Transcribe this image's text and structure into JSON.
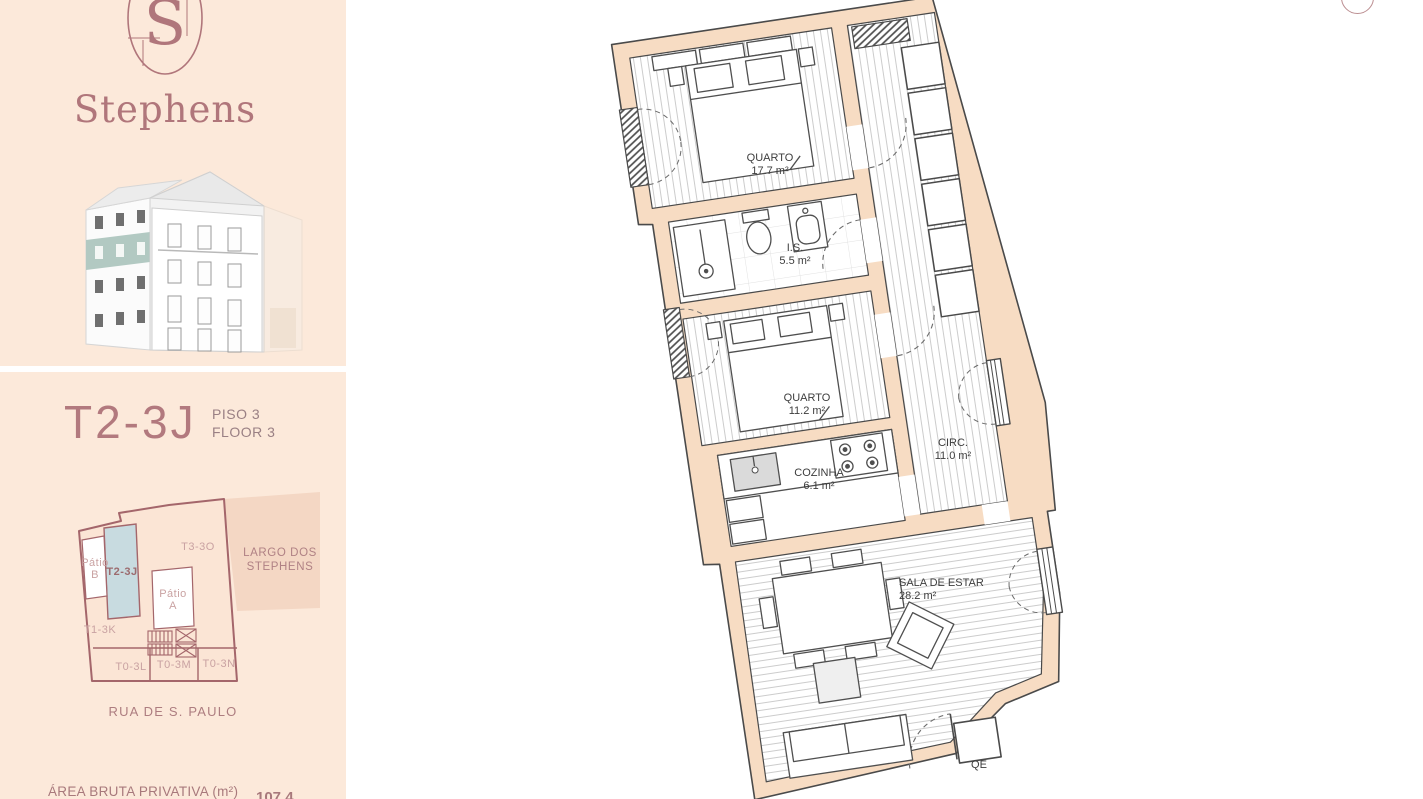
{
  "sidebar": {
    "brand": {
      "monogram": "S",
      "name": "Stephens"
    },
    "unit": {
      "code": "T2-3J",
      "floor_line1": "PISO 3",
      "floor_line2": "FLOOR 3"
    },
    "site_plan": {
      "highlight": "T2-3J",
      "t3": "T3-3O",
      "t1": "T1-3K",
      "t0l": "T0-3L",
      "t0m": "T0-3M",
      "t0n": "T0-3N",
      "patio_b": {
        "line1": "Pátio",
        "line2": "B"
      },
      "patio_a": {
        "line1": "Pátio",
        "line2": "A"
      },
      "square": {
        "line1": "LARGO DOS",
        "line2": "STEPHENS"
      },
      "street": "RUA DE S. PAULO"
    },
    "area": {
      "label": "ÁREA BRUTA PRIVATIVA (m²)",
      "value": "107.4"
    }
  },
  "floor_plan": {
    "rooms": [
      {
        "name": "QUARTO",
        "area": "17.7 m²"
      },
      {
        "name": "I.S.",
        "area": "5.5 m²"
      },
      {
        "name": "QUARTO",
        "area": "11.2 m²"
      },
      {
        "name": "COZINHA",
        "area": "6.1 m²"
      },
      {
        "name": "CIRC.",
        "area": "11.0 m²"
      },
      {
        "name": "SALA DE ESTAR",
        "area": "28.2 m²"
      }
    ],
    "qe": "QE"
  },
  "colors": {
    "accent": "#b0767b",
    "sidebar_bg": "#fce9da",
    "wall": "#f7dcc3",
    "plan_line": "#4a4a4a",
    "site_outline": "#a4666b",
    "unit_highlight": "#c8dbe0",
    "square_fill": "#f4d7c4",
    "teal_band": "#b2c9c2"
  }
}
